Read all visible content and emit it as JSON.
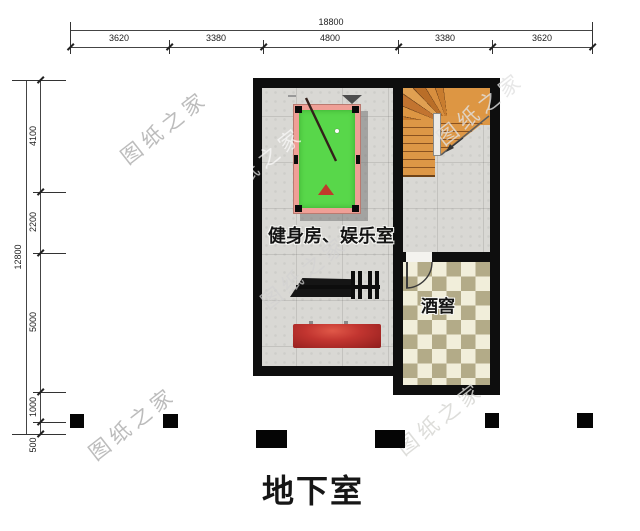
{
  "plan_title": "地下室",
  "watermark_text": "图纸之家",
  "rooms": {
    "gym_entertainment": "健身房、娱乐室",
    "wine_cellar": "酒窖"
  },
  "dimensions": {
    "top_total": "18800",
    "top_segments": [
      "3620",
      "3380",
      "4800",
      "3380",
      "3620"
    ],
    "left_total": "12800",
    "left_segments": [
      "4100",
      "2200",
      "5000",
      "1000",
      "500"
    ]
  },
  "colors": {
    "wall": "#0e0e0e",
    "pool_felt": "#58d74a",
    "pool_rail": "#ef9f96",
    "stair_wood": "#d88f3f",
    "checker_dark": "#b3ab88",
    "checker_light": "#f1eeda",
    "mat_red": "#c23530",
    "floor_tile": "#d9d8d4"
  }
}
